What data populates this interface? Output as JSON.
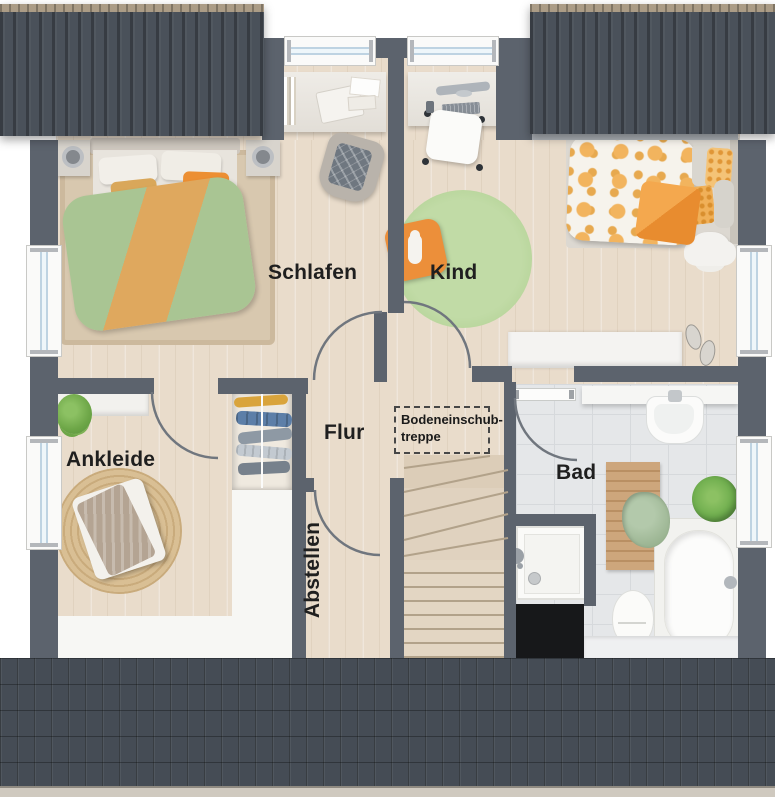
{
  "floorplan": {
    "rooms": {
      "schlafen": "Schlafen",
      "kind": "Kind",
      "ankleide": "Ankleide",
      "flur": "Flur",
      "abstellen": "Abstellen",
      "bad": "Bad"
    },
    "annotations": {
      "attic_hatch_line1": "Bodeneinschub-",
      "attic_hatch_line2": "treppe"
    },
    "colors": {
      "wall": "#5c636d",
      "roof_dark": "#4a515a",
      "wood_floor": "#e9dccb",
      "tile_floor": "#e5e7e9",
      "accent_orange": "#ee9a3c",
      "accent_green": "#a9c593",
      "label_text": "#1f1f1f"
    }
  }
}
